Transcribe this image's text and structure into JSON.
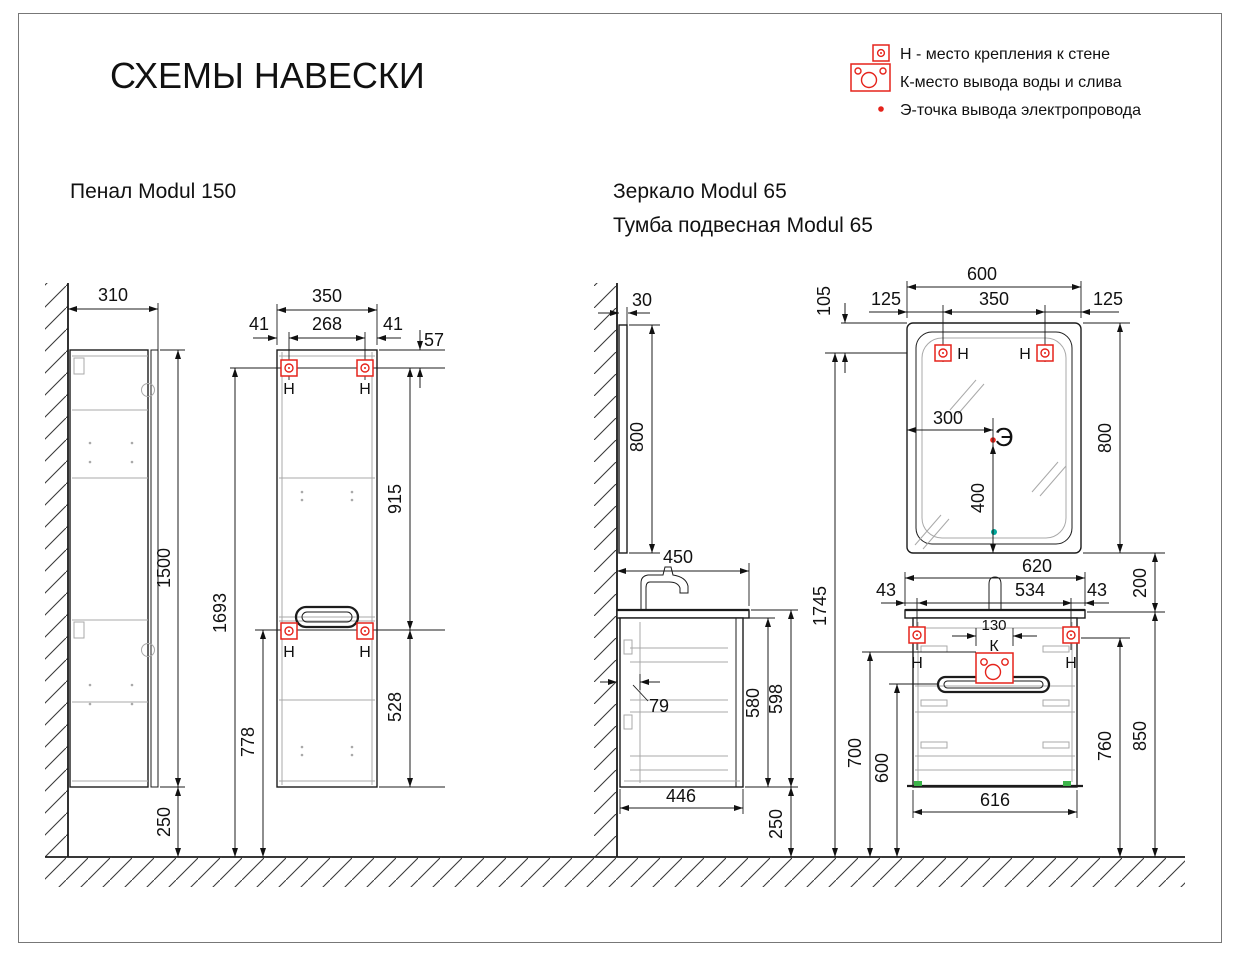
{
  "title": "СХЕМЫ НАВЕСКИ",
  "legend": {
    "items": [
      {
        "icon": "mount-point-icon",
        "label": "Н - место крепления к стене"
      },
      {
        "icon": "water-outlet-icon",
        "label": "К-место вывода воды и слива"
      },
      {
        "icon": "electric-point-icon",
        "label": "Э-точка вывода электропровода"
      }
    ]
  },
  "sections": {
    "pencase": {
      "title": "Пенал Modul 150"
    },
    "mirror": {
      "title": "Зеркало Modul 65"
    },
    "vanity": {
      "title": "Тумба подвесная Modul 65"
    }
  },
  "marks": {
    "mount": "Н",
    "water": "К",
    "electric": "Э"
  },
  "dims": {
    "pencase_side": {
      "depth": "310",
      "height": "1500",
      "floor_gap": "250"
    },
    "pencase_front": {
      "width": "350",
      "edge_left": "41",
      "mount_span": "268",
      "edge_right": "41",
      "top_to_mount": "57",
      "mount_to_mount": "915",
      "mount_to_bottom": "528",
      "floor_to_top_mount": "1693",
      "floor_to_lower_mount": "778"
    },
    "mirror_side": {
      "depth": "30",
      "height": "800"
    },
    "vanity_side": {
      "counter_depth": "450",
      "back_gap": "79",
      "body_height": "580",
      "outer_height": "598",
      "body_depth": "446",
      "floor_gap": "250"
    },
    "combo": {
      "floor_to_mirror_mount": "1745",
      "mirror_to_counter": "200"
    },
    "mirror_front": {
      "width": "600",
      "edge_left": "125",
      "mount_span": "350",
      "edge_right": "125",
      "top_to_mount": "105",
      "electric_from_left": "300",
      "electric_to_bottom": "400",
      "height": "800"
    },
    "vanity_front": {
      "counter_width": "620",
      "edge_left": "43",
      "mount_span": "534",
      "edge_right": "43",
      "outlet_width": "130",
      "body_width": "616",
      "floor_to_outlet_top": "700",
      "floor_to_handle": "600",
      "floor_to_mount": "760",
      "floor_to_counter": "850"
    }
  },
  "colors": {
    "accent_red": "#e5231b",
    "outline": "#1c1c1c",
    "detail_gray": "#a9a9a9",
    "teal_dot": "#00a99d",
    "green_dot": "#3cb44a"
  }
}
